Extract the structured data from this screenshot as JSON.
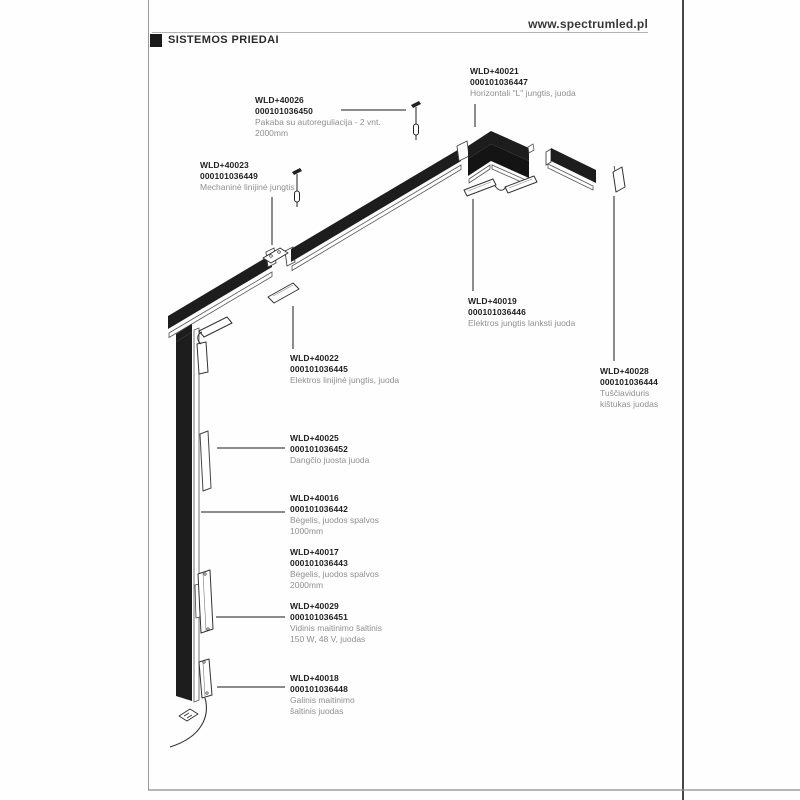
{
  "header": {
    "site_url": "www.spectrumled.pl"
  },
  "section": {
    "title": "SISTEMOS PRIEDAI"
  },
  "parts": [
    {
      "code": "WLD+40026",
      "sku": "000101036450",
      "desc": [
        "Pakaba su autoreguliacija - 2 vnt.",
        "2000mm"
      ]
    },
    {
      "code": "WLD+40021",
      "sku": "000101036447",
      "desc": [
        "Horizontali \"L\" jungtis, juoda"
      ]
    },
    {
      "code": "WLD+40023",
      "sku": "000101036449",
      "desc": [
        "Mechaninė linijinė jungtis"
      ]
    },
    {
      "code": "WLD+40019",
      "sku": "000101036446",
      "desc": [
        "Elektros jungtis lanksti juoda"
      ]
    },
    {
      "code": "WLD+40022",
      "sku": "000101036445",
      "desc": [
        "Elektros linijinė jungtis, juoda"
      ]
    },
    {
      "code": "WLD+40028",
      "sku": "000101036444",
      "desc": [
        "Tuščiaviduris",
        "kištukas juodas"
      ]
    },
    {
      "code": "WLD+40025",
      "sku": "000101036452",
      "desc": [
        "Dangčio juosta juoda"
      ]
    },
    {
      "code": "WLD+40016",
      "sku": "000101036442",
      "desc": [
        "Bėgelis, juodos spalvos",
        "1000mm"
      ]
    },
    {
      "code": "WLD+40017",
      "sku": "000101036443",
      "desc": [
        "Bėgelis, juodos spalvos",
        "2000mm"
      ]
    },
    {
      "code": "WLD+40029",
      "sku": "000101036451",
      "desc": [
        "Vidinis maitinimo šaltinis",
        "150 W, 48 V, juodas"
      ]
    },
    {
      "code": "WLD+40018",
      "sku": "000101036448",
      "desc": [
        "Galinis maitinimo",
        "šaltinis juodas"
      ]
    }
  ],
  "colors": {
    "track_black": "#1d1d1d",
    "outline": "#333333",
    "code_text": "#1f1f1f",
    "desc_text": "#8f8f8f",
    "border": "#1a1a1a"
  }
}
